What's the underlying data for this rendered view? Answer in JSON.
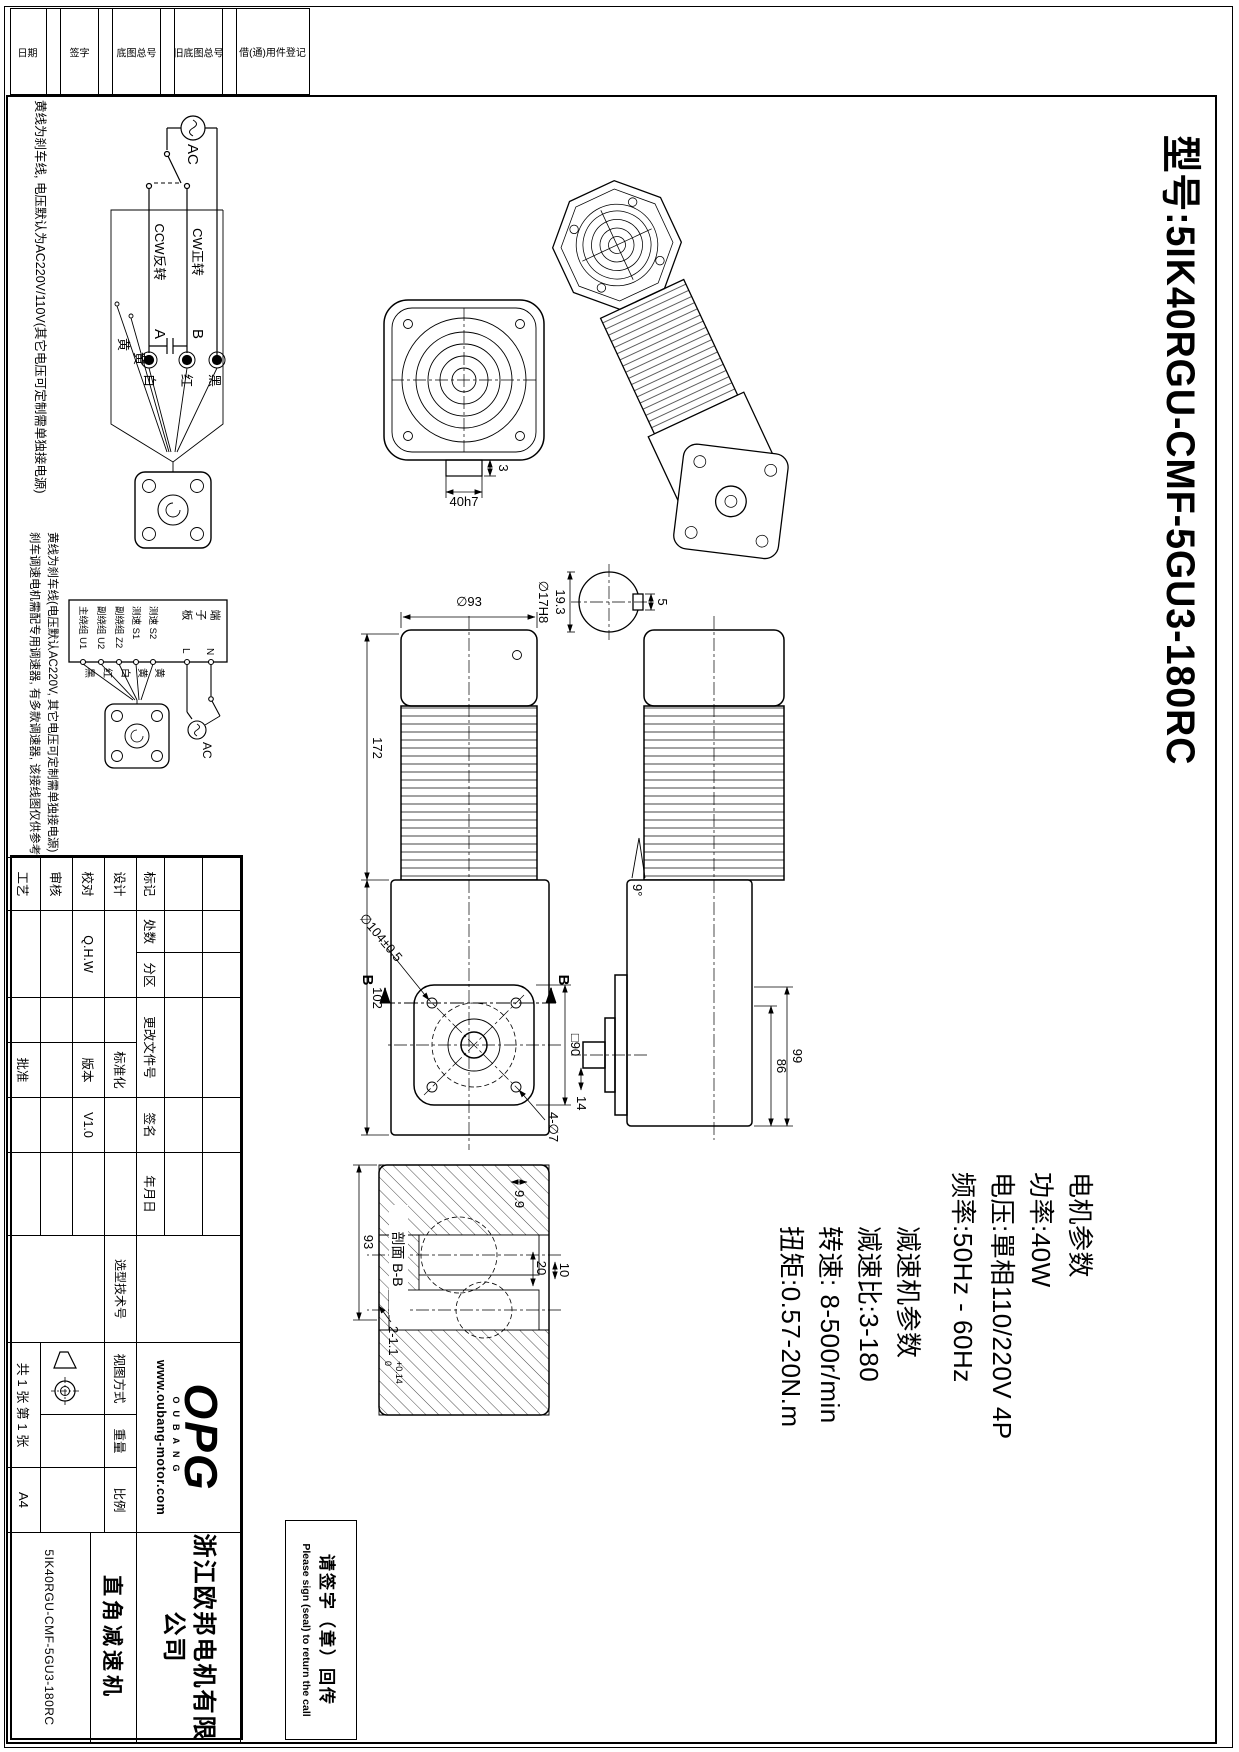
{
  "page": {
    "model_title": "型号:5IK40RGU-CMF-5GU3-180RC"
  },
  "motor_params": {
    "heading": "电机参数",
    "power": "功率:40W",
    "voltage": "电压:單相110/220V 4P",
    "frequency": "频率:50Hz - 60Hz"
  },
  "gear_params": {
    "heading": "减速机参数",
    "ratio": "减速比:3-180",
    "speed": "转速: 8-500r/min",
    "torque": "扭矩:0.57-20N.m"
  },
  "wiring1": {
    "ac": "AC",
    "cw": "CW正转",
    "ccw": "CCW反转",
    "term_a": "A",
    "term_b": "B",
    "c1": "黑",
    "c2": "红",
    "c3": "白",
    "c4": "黄",
    "c5": "黄",
    "note": "黄线为刹车线, 电压默认为AC220V/110V(其它电压可定制需单独接电源)"
  },
  "wiring2": {
    "board": "端子板",
    "t1": "测速 S2",
    "t2": "测速 S1",
    "t3": "副绕组 Z2",
    "t4": "副绕组 U2",
    "t5": "主绕组 U1",
    "c1": "黄",
    "c2": "黄",
    "c3": "白",
    "c4": "红",
    "c5": "黑",
    "n": "N",
    "l": "L",
    "ac": "AC",
    "note1": "黄线为刹车线(电压默认AC220V, 其它电压可定制需单独接电源)",
    "note2": "刹车调速电机需配专用调速器, 有多款调速器, 该接线图仅供参考"
  },
  "dims": {
    "fan_shaft": "40h7",
    "fan_offset": "3",
    "shaft_dia": "∅17H8",
    "key_flat": "19.3",
    "key_width": "5",
    "motor_dia": "∅93",
    "motor_len": "172",
    "gear_len": "102",
    "flange_diag": "∅104±0.5",
    "flange_sq": "□90",
    "flange_holes": "4-∅7",
    "sec_letter": "B",
    "angle": "9°",
    "shaft_len": "14",
    "gear_w": "86",
    "gear_total": "99",
    "section_label": "剖面 B-B",
    "sec_h": "93",
    "sec_d1": "9.9",
    "sec_d2": "20",
    "sec_d3": "10",
    "slot": "2-1.1",
    "slot_tol_hi": "+0.14",
    "slot_tol_lo": "0"
  },
  "titleblock": {
    "mark": "标记",
    "count": "处数",
    "zone": "分区",
    "change_doc": "更改文件号",
    "signature": "签名",
    "date": "年月日",
    "design": "设计",
    "proof": "校对",
    "review": "审核",
    "process": "工艺",
    "approve": "批准",
    "standardize": "标准化",
    "version_label": "版本",
    "version": "V1.0",
    "designer": "Q.H.W",
    "select_no": "选型技术号",
    "view_mode": "视图方式",
    "weight": "重量",
    "scale": "比例",
    "sheets": "共 1 张 第 1 张",
    "paper": "A4",
    "company_line1": "浙江欧邦电机有限",
    "company_line2": "公司",
    "product": "直角减速机",
    "drawing_no": "5IK40RGU-CMF-5GU3-180RC",
    "website": "www.oubang-motor.com",
    "logo": "OPG",
    "logo_sub": "OUBANG"
  },
  "binding": {
    "b1": "借(通)用件登记",
    "b2": "旧底图总号",
    "b3": "底图总号",
    "b4": "签字",
    "b5": "日期"
  },
  "signbox": {
    "line1": "请签字（章）回传",
    "line2": "Please sign (seal) to return the call"
  }
}
